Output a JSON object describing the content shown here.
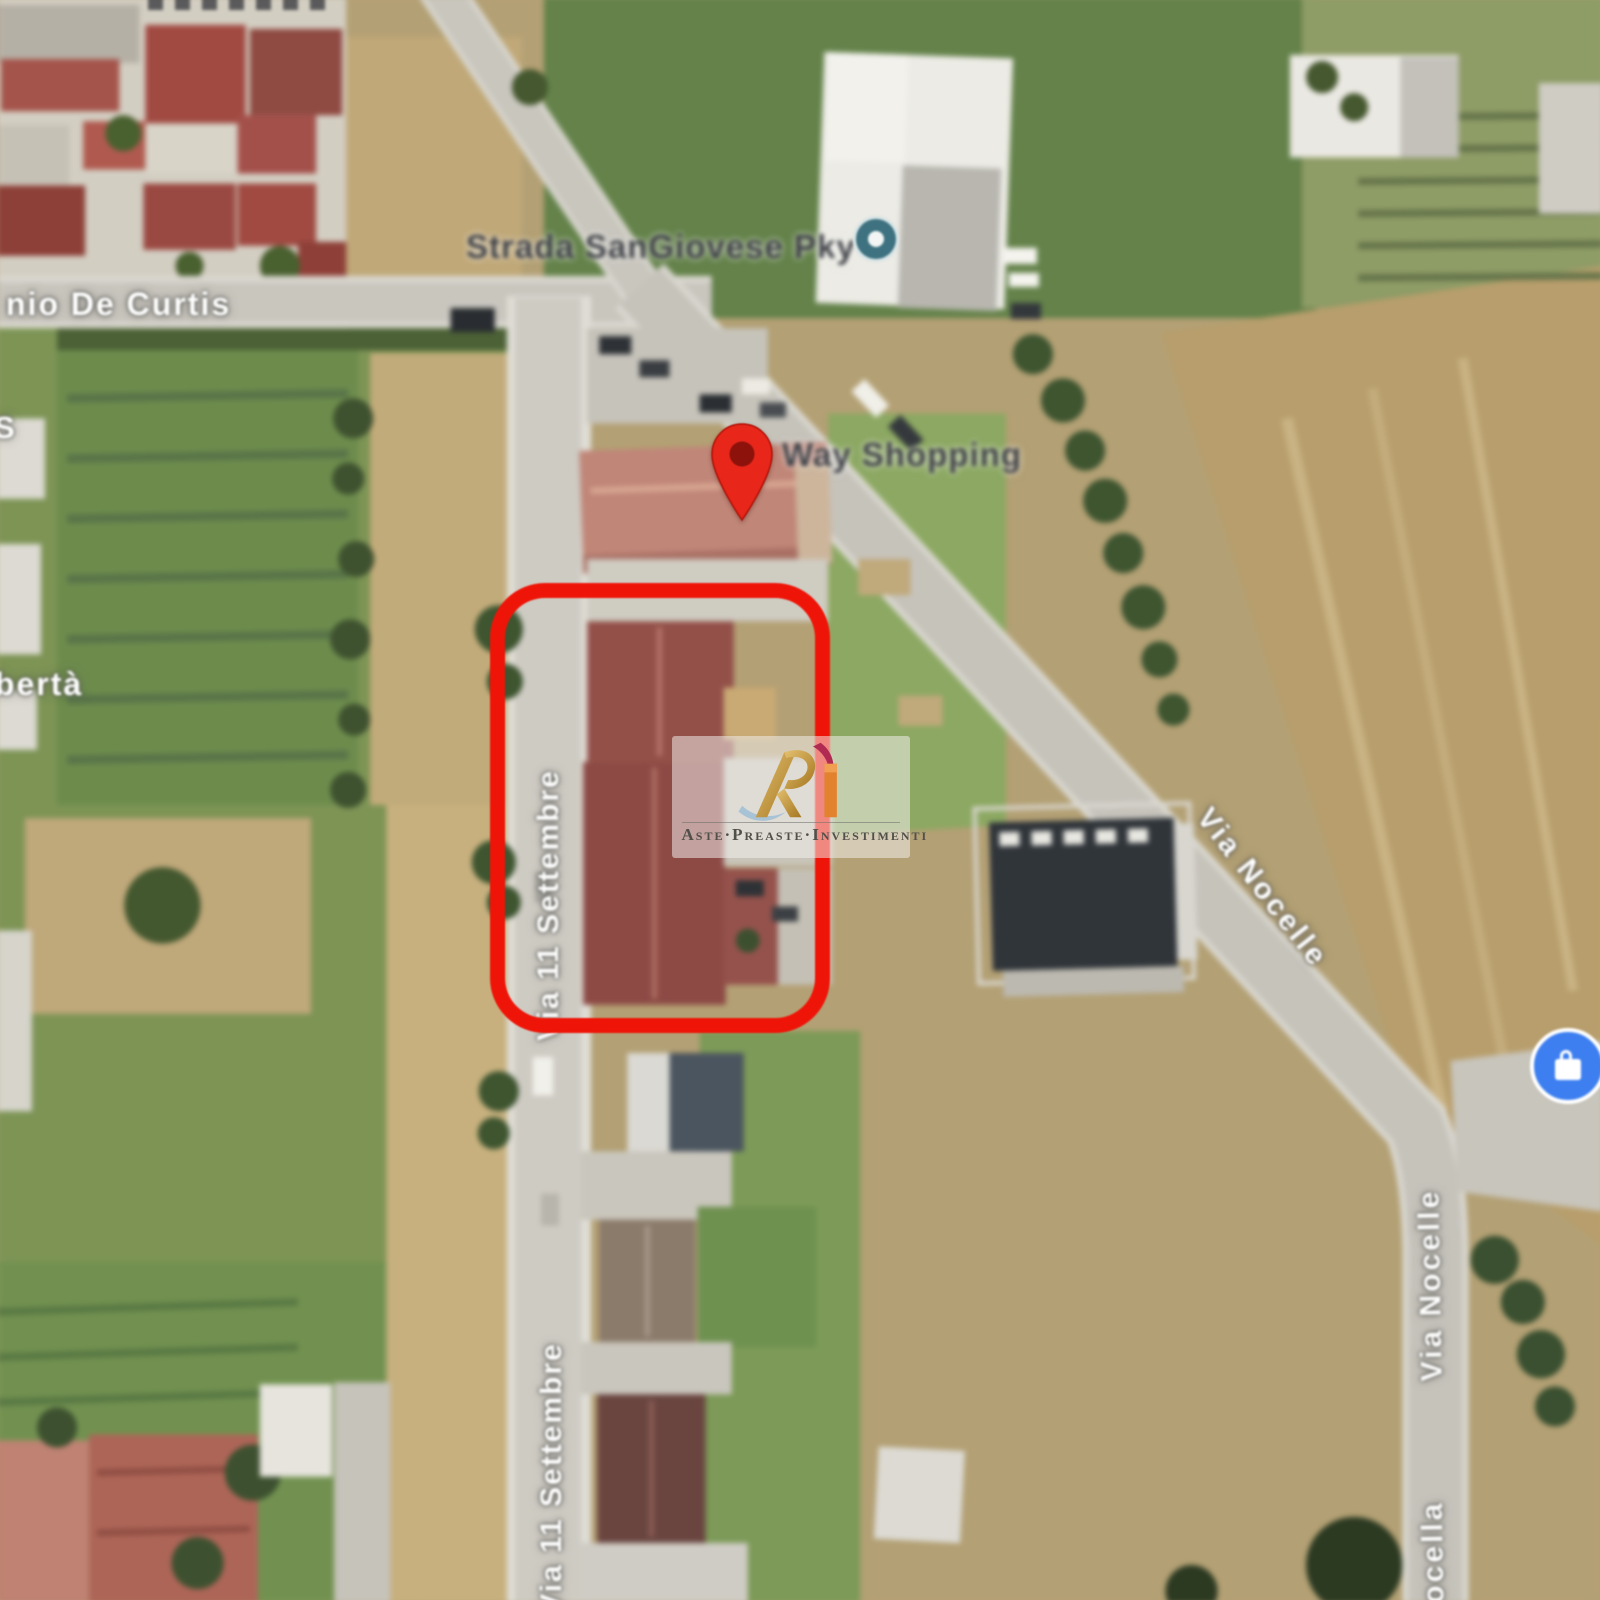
{
  "map": {
    "view": "satellite",
    "street_labels": {
      "de_curtis": "nio De Curtis",
      "settembre_upper": "Via 11 Settembre",
      "settembre_lower": "Via 11 Settembre",
      "nocelle_upper": "Via Nocelle",
      "nocelle_lower": "Via Nocelle",
      "nocelle_bottom_partial": "a Nocella",
      "left_edge_partial_s": "S",
      "left_edge_partial_liberta": "ibertà"
    },
    "poi_labels": {
      "top_road_poi": "Strada SanGiovese Pky",
      "pin_poi": "Way Shopping"
    },
    "markers": {
      "highlight_color": "#ee1508",
      "pin_color": "#e8261a",
      "pin_hole_color": "#8c120b",
      "poi_blue": "#3d7ff0",
      "poi_teal": "#3e7280"
    },
    "watermark": {
      "brand": "Aste·Preaste·Investimenti",
      "logo_monogram": "RI",
      "gold": "#c79a3f",
      "magenta": "#b12a52",
      "orange": "#e2822e",
      "silver_blue": "#a8c2d6"
    }
  }
}
